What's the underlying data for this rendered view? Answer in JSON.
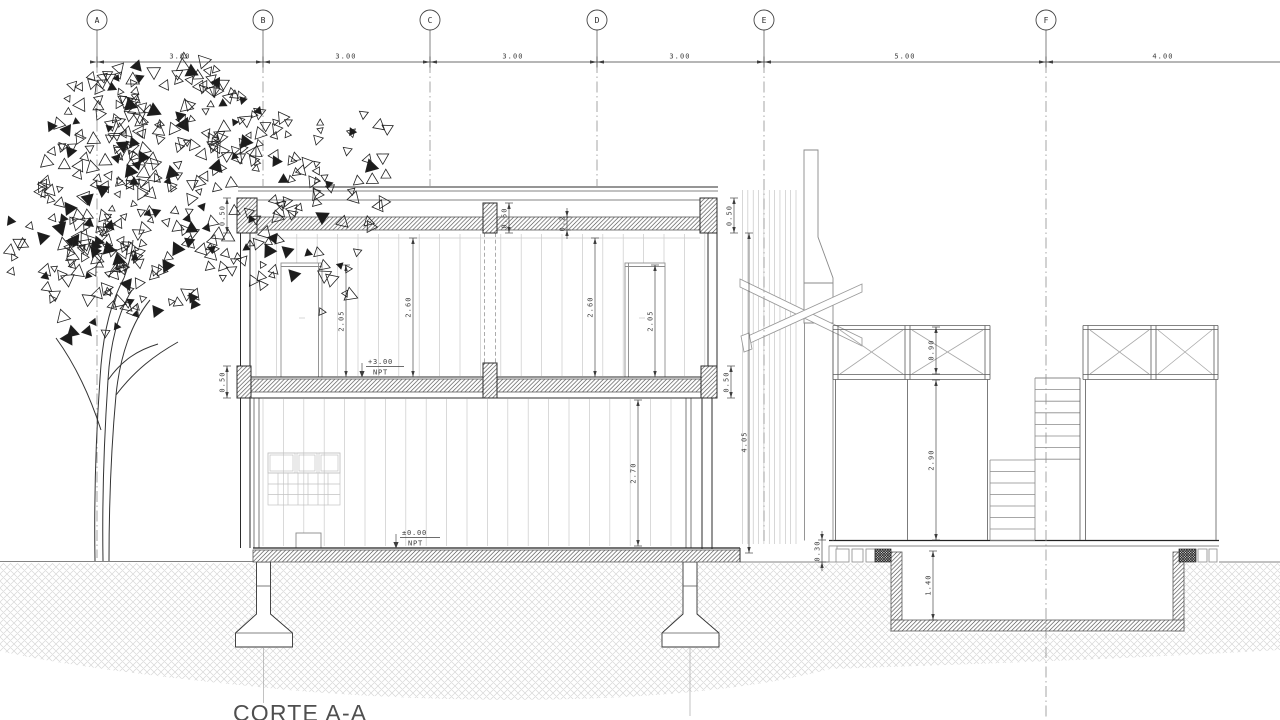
{
  "drawing_title": "CORTE A-A",
  "grid": {
    "labels": [
      "A",
      "B",
      "C",
      "D",
      "E",
      "F"
    ],
    "spans": [
      "3.00",
      "3.00",
      "3.00",
      "3.00",
      "5.00",
      "4.00"
    ]
  },
  "levels": {
    "upper_value": "+3.00",
    "upper_ref": "NPT",
    "ground_value": "±0.00",
    "ground_ref": "NPT"
  },
  "dims": {
    "parapet_left": "0.50",
    "roof_stub": "0.50",
    "roof_slab": "0.2",
    "parapet_right": "0.50",
    "door_left": "2.05",
    "storey_left": "2.60",
    "storey_right": "2.60",
    "door_right": "2.05",
    "floor_beam_left": "0.50",
    "floor_beam_right": "0.50",
    "ground_storey": "2.70",
    "section_height": "4.05",
    "railing_height": "0.90",
    "railing_clear": "2.90",
    "deck_thickness": "0.30",
    "pool_depth": "1.40"
  }
}
